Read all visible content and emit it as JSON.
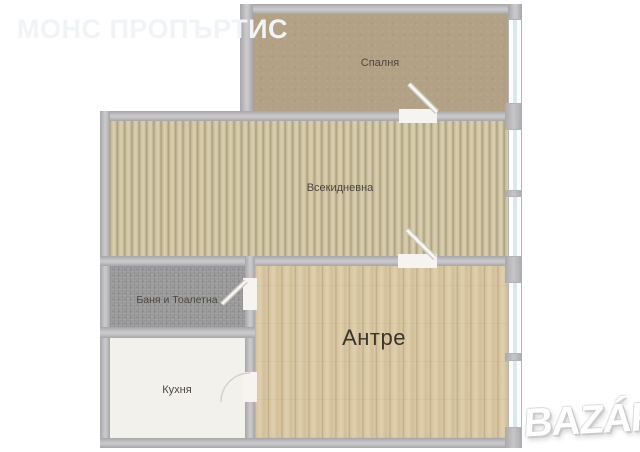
{
  "watermarks": {
    "agency": "МОНС ПРОПЪРТИС",
    "portal_logo": "BAZÁR"
  },
  "rooms": {
    "bedroom": {
      "label": "Спалня"
    },
    "living": {
      "label": "Всекидневна"
    },
    "bath": {
      "label": "Баня и Тоалетна"
    },
    "kitchen": {
      "label": "Кухня"
    },
    "hall": {
      "label": "Антре"
    }
  },
  "colors": {
    "wall": "#b9b9bb",
    "bedroom_floor": "#b2a184",
    "living_floor": "#cfc4a2",
    "bath_floor": "#9b9b9b",
    "kitchen_floor": "#f3f1ec",
    "hall_floor": "#d8c5a1",
    "window_glass": "#d9e9e9",
    "label_text": "#4c4741"
  }
}
